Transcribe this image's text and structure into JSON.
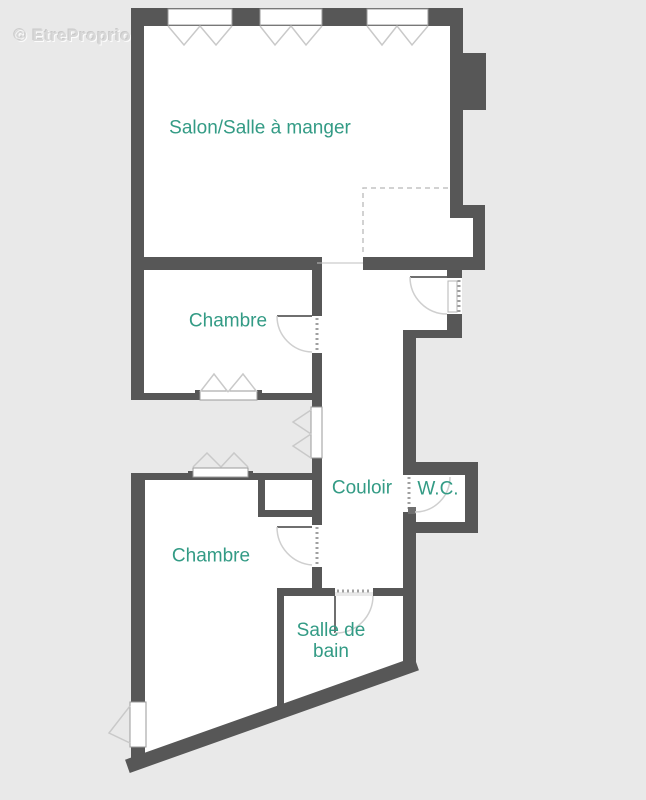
{
  "watermark": {
    "text": "© EtreProprio.com"
  },
  "floorplan": {
    "rooms": [
      {
        "id": "salon",
        "label": "Salon/Salle à manger"
      },
      {
        "id": "chambre-1",
        "label": "Chambre"
      },
      {
        "id": "chambre-2",
        "label": "Chambre"
      },
      {
        "id": "couloir",
        "label": "Couloir"
      },
      {
        "id": "wc",
        "label": "W.C."
      },
      {
        "id": "salle-de-bain",
        "label": "Salle de bain"
      }
    ],
    "colors": {
      "background": "#e9e9e9",
      "interior": "#ffffff",
      "wall": "#575757",
      "room_label": "#339b85",
      "fixture_line": "#c9c9c9",
      "watermark": "#d8d8d8"
    }
  }
}
